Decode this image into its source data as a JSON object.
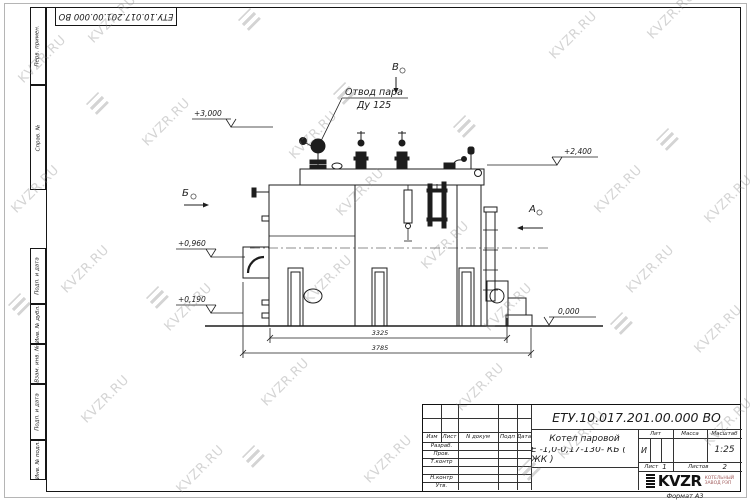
{
  "doc": {
    "number_top": "ЕТУ.10.017.201.00.000  ВО",
    "format": "Формат А3"
  },
  "watermark": {
    "text": "KVZR.RU"
  },
  "decor": {
    "watermarks": [
      {
        "x": 12,
        "y": 52
      },
      {
        "x": 82,
        "y": 12
      },
      {
        "x": 283,
        "y": 128
      },
      {
        "x": 543,
        "y": 28
      },
      {
        "x": 641,
        "y": 8
      },
      {
        "x": 5,
        "y": 182
      },
      {
        "x": 136,
        "y": 115
      },
      {
        "x": 330,
        "y": 185
      },
      {
        "x": 415,
        "y": 238
      },
      {
        "x": 588,
        "y": 182
      },
      {
        "x": 698,
        "y": 192
      },
      {
        "x": 55,
        "y": 262
      },
      {
        "x": 158,
        "y": 300
      },
      {
        "x": 298,
        "y": 272
      },
      {
        "x": 478,
        "y": 300
      },
      {
        "x": 620,
        "y": 262
      },
      {
        "x": 75,
        "y": 392
      },
      {
        "x": 255,
        "y": 375
      },
      {
        "x": 450,
        "y": 380
      },
      {
        "x": 688,
        "y": 322
      },
      {
        "x": 170,
        "y": 462
      },
      {
        "x": 358,
        "y": 452
      },
      {
        "x": 552,
        "y": 428
      },
      {
        "x": 698,
        "y": 415
      }
    ],
    "logos": [
      {
        "x": 238,
        "y": 8
      },
      {
        "x": 86,
        "y": 92
      },
      {
        "x": 333,
        "y": 82
      },
      {
        "x": 453,
        "y": 115
      },
      {
        "x": 656,
        "y": 128
      },
      {
        "x": 8,
        "y": 293
      },
      {
        "x": 146,
        "y": 286
      },
      {
        "x": 610,
        "y": 312
      },
      {
        "x": 242,
        "y": 445
      },
      {
        "x": 518,
        "y": 458
      }
    ]
  },
  "margin_stamps": {
    "perv_primen": "Перв. примен.",
    "sprav_no": "Справ. №",
    "podp_data_1": "Подп. и дата",
    "inv_dubl": "Инв. № дубл.",
    "vzam_inv": "Взам. инв. №",
    "podp_data_2": "Подп. и дата",
    "inv_podl": "Инв. № подл."
  },
  "annotations": {
    "steam_outlet_line1": "Отвод пара",
    "steam_outlet_line2": "Ду 125",
    "elev_3000": "+3,000",
    "elev_2400": "+2,400",
    "elev_0960": "+0,960",
    "elev_0190": "+0,190",
    "elev_0000": "0,000",
    "dim_3325": "3325",
    "dim_3785": "3785",
    "view_a": "А",
    "view_b": "Б",
    "view_v": "В"
  },
  "title_block": {
    "doc_number": "ЕТУ.10.017.201.00.000  ВО",
    "product_line1": "Котел паровой",
    "product_line2": "Е -1,0-0,17-130- КБ ( ЖК )",
    "rev_headers": [
      "Изм",
      "Лист",
      "N докум",
      "Подп",
      "Дата"
    ],
    "roles": [
      "Разраб.",
      "Пров.",
      "Т.контр",
      "",
      "Н.контр",
      "Утв."
    ],
    "lit_label": "Лит",
    "lit_value": "И",
    "mass_label": "Масса",
    "scale_label": "Масштаб",
    "scale_value": "1:25",
    "sheet_label": "Лист",
    "sheet_value": "1",
    "sheets_label": "Листов",
    "sheets_value": "2",
    "logo_text": "KVZR",
    "logo_sub1": "КОТЕЛЬНЫЙ",
    "logo_sub2": "ЗАВОД РЭП"
  }
}
